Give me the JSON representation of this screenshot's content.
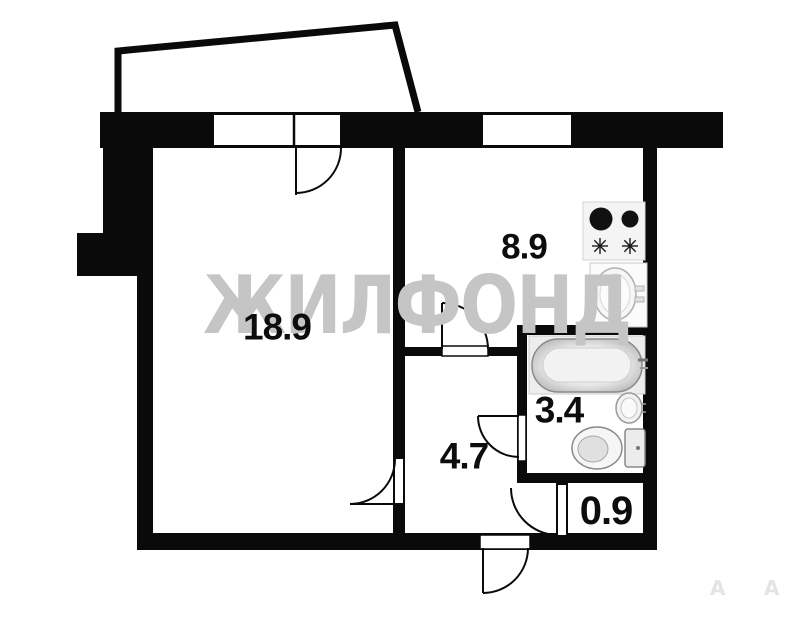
{
  "plan": {
    "type": "apartment-floor-plan",
    "watermark": {
      "text": "ЖИЛФОНД",
      "color": "#c5c5c5"
    },
    "rooms": [
      {
        "id": "living-room",
        "area_label": "18.9"
      },
      {
        "id": "kitchen",
        "area_label": "8.9"
      },
      {
        "id": "bathroom",
        "area_label": "3.4"
      },
      {
        "id": "hallway",
        "area_label": "4.7"
      },
      {
        "id": "vestibule",
        "area_label": "0.9"
      }
    ],
    "fixtures": [
      "stove",
      "kitchen-sink",
      "bathtub",
      "bathroom-sink",
      "toilet"
    ],
    "features": [
      "balcony-outline",
      "balcony-door",
      "living-room-window",
      "kitchen-window",
      "living-room-door",
      "kitchen-door",
      "bathroom-door",
      "vestibule-door",
      "entry-door"
    ],
    "corner_marks": [
      "А",
      "А"
    ],
    "colors": {
      "wall": "#0a0a0a",
      "background": "#ffffff",
      "watermark": "#c5c5c5",
      "fixture_outline": "#8a8a8a"
    }
  }
}
